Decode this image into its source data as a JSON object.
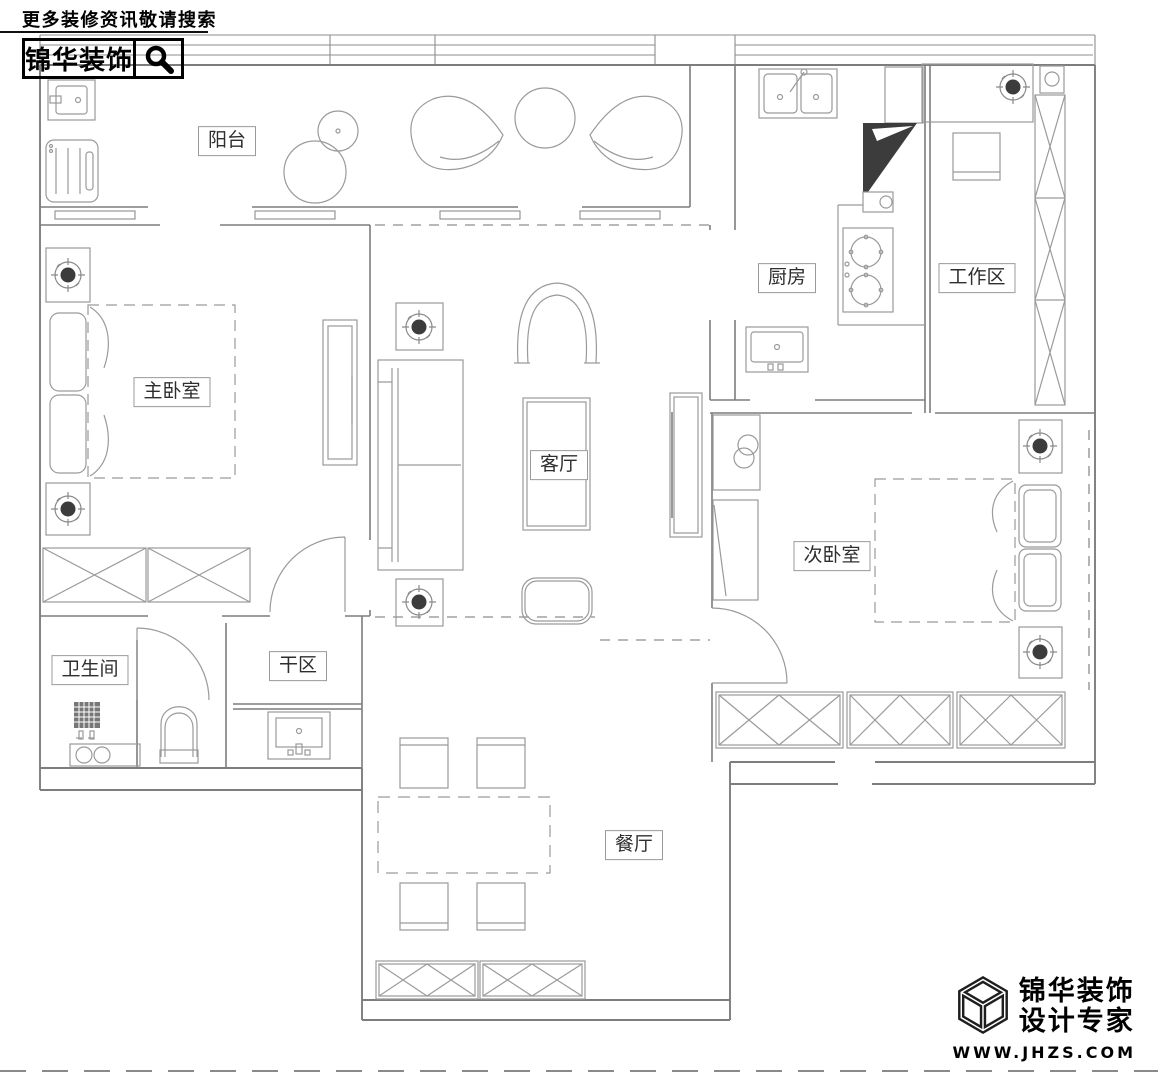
{
  "header": {
    "tagline": "更多装修资讯敬请搜索",
    "brand": "锦华装饰",
    "search_icon": "magnifier-icon"
  },
  "rooms": {
    "balcony": "阳台",
    "master_bedroom": "主卧室",
    "living_room": "客厅",
    "kitchen": "厨房",
    "work_area": "工作区",
    "second_bedroom": "次卧室",
    "bathroom": "卫生间",
    "dry_area": "干区",
    "dining_room": "餐厅"
  },
  "footer": {
    "brand": "锦华装饰",
    "slogan": "设计专家",
    "website": "WWW.JHZS.COM",
    "cube_icon": "isometric-cube-icon"
  },
  "colors": {
    "wall_line": "#7d7d7d",
    "furniture_line": "#9a9a9a",
    "dark_fill": "#3c3c3c",
    "label_text": "#2e2e2e",
    "brand_text": "#000000",
    "background": "#ffffff"
  }
}
